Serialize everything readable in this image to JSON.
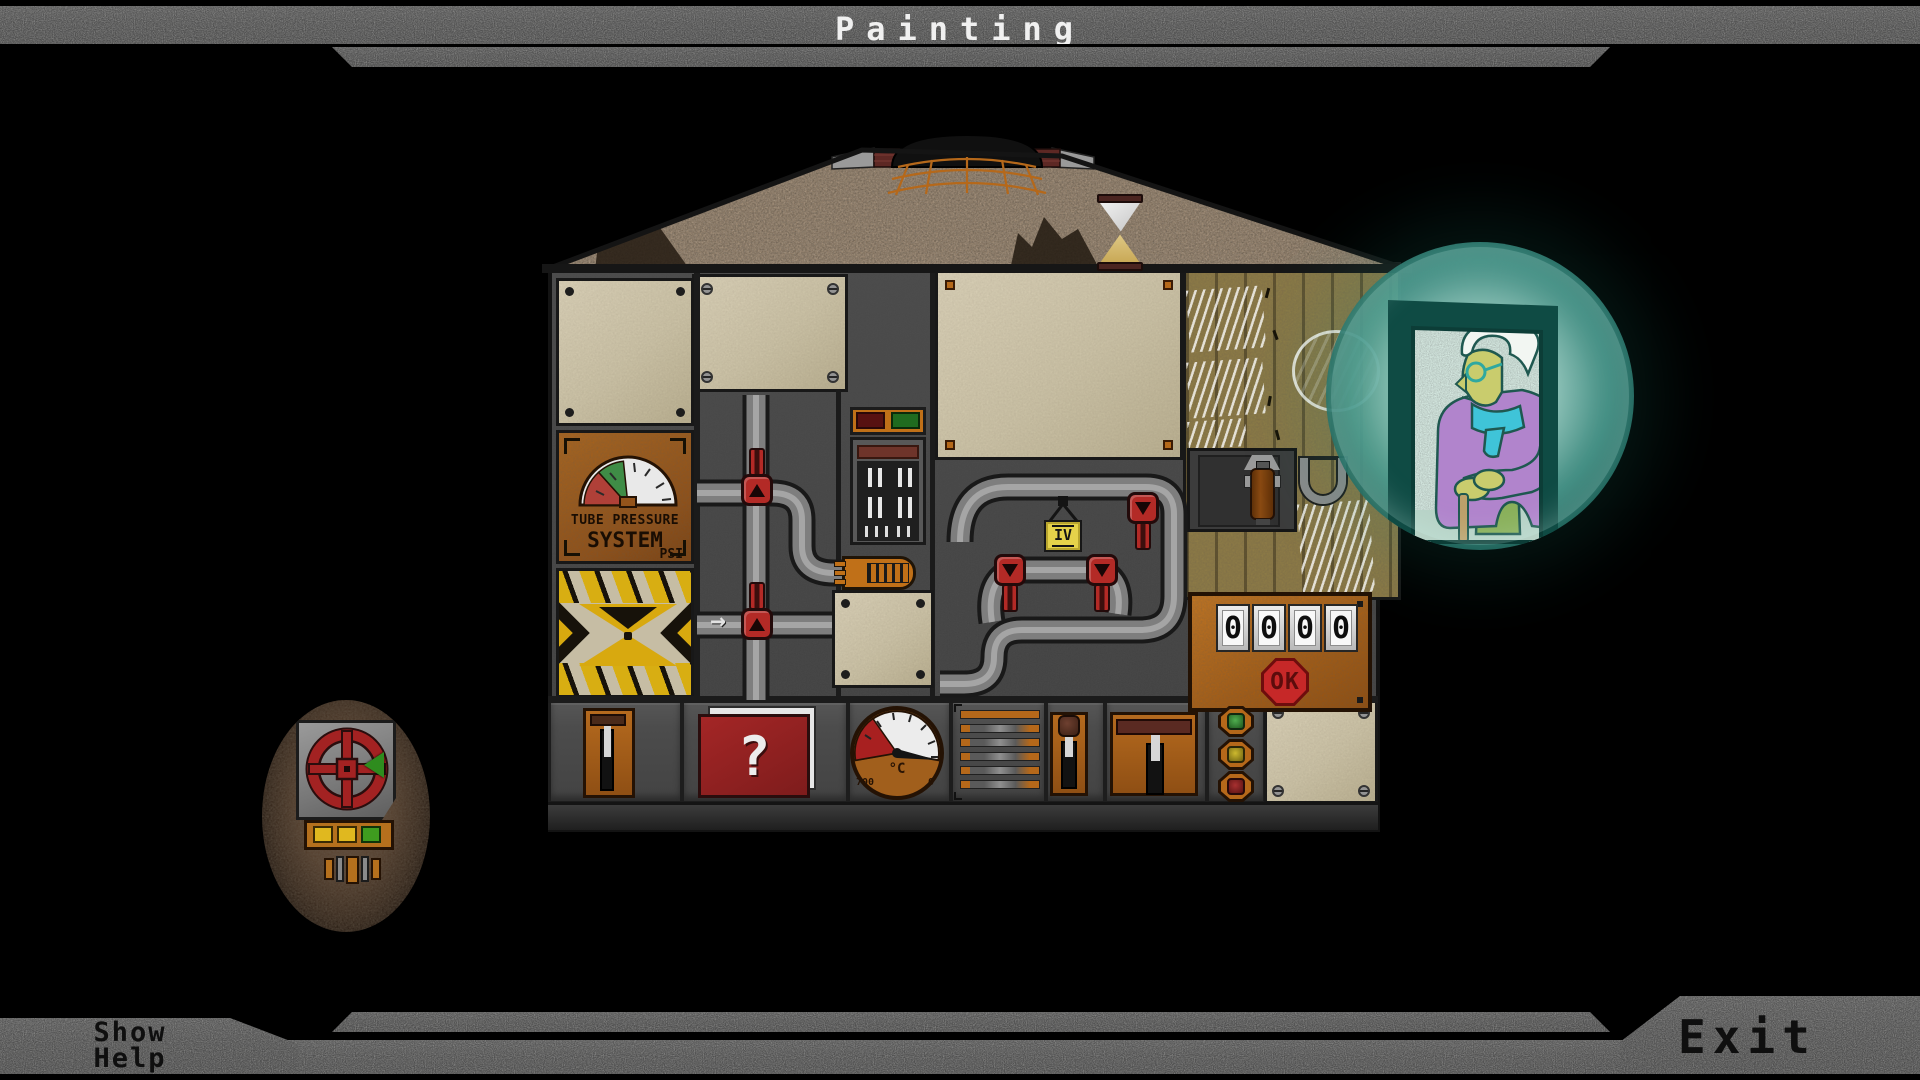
{
  "window": {
    "title": "Painting"
  },
  "footer": {
    "show_help": {
      "line1": "Show",
      "line2": "Help"
    },
    "exit_label": "Exit"
  },
  "machine": {
    "pressure_gauge": {
      "title_line1": "TUBE PRESSURE",
      "title_line2": "SYSTEM",
      "unit": "PSI"
    },
    "flow_arrow": "→",
    "valve_tag_label": "IV",
    "code_panel": {
      "digits": [
        "0",
        "0",
        "0",
        "0"
      ],
      "ok_label": "OK"
    },
    "temp_gauge": {
      "unit": "°C",
      "max_label": "700",
      "min_label": "0"
    },
    "help_book_label": "?"
  },
  "icons": {
    "hazard": "exclamation-bowtie",
    "help_book": "question-mark-book",
    "ok_button": "stop-octagon",
    "hourglass": "hourglass",
    "pipe_valve": "red-tap-handle",
    "hand_wheel": "red-handwheel",
    "porthole": "old-lady-through-teal-porthole",
    "flow": "right-arrow"
  },
  "colors": {
    "frame_gray": "#555555",
    "machine_gray": "#4a4a4a",
    "panel_beige": "#cfc5a6",
    "panel_orange": "#a95f1b",
    "valve_red": "#b32a26",
    "hazard_yellow": "#d8a90f",
    "tag_yellow": "#e5d24a",
    "ok_red": "#c62828",
    "porthole_teal": "#2e8c80",
    "wood_olive": "#8d7b46",
    "indicator_green": "#2d7a2d",
    "indicator_yellow": "#b5a11c",
    "indicator_red": "#8c1a1a"
  }
}
